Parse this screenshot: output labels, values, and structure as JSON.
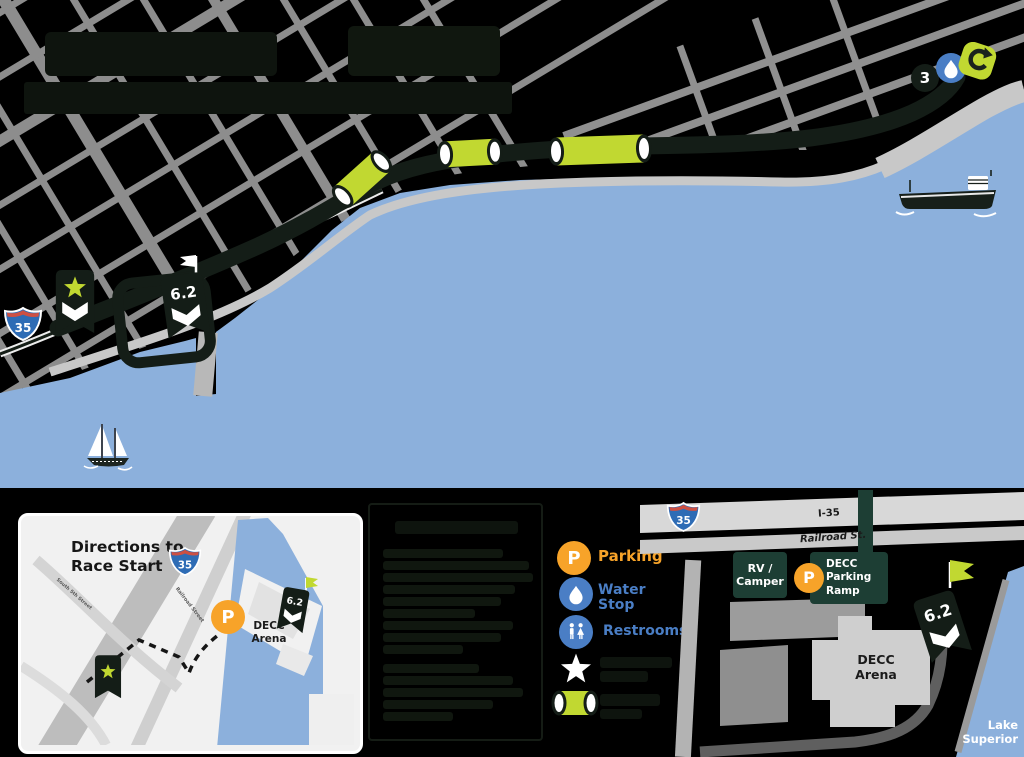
{
  "colors": {
    "water": "#8cb0dc",
    "course_dark": "#141d17",
    "lime_accent": "#c1d831",
    "legend_blue": "#4a7ec5",
    "parking_orange": "#f7a329",
    "panel_dark_green": "#1d3e34",
    "road_gray": "#8e8e8e",
    "interstate_blue": "#2e6cb5",
    "interstate_red": "#cd5043"
  },
  "main_map": {
    "interstate_shield": "35",
    "mile_marker_3": "3",
    "finish_marker": "6.2"
  },
  "inset_directions": {
    "title_line1": "Directions to",
    "title_line2": "Race Start",
    "interstate_shield": "35",
    "street_south5th": "South 5th Street",
    "street_railroad": "Railroad Street",
    "parking_symbol": "P",
    "arena_line1": "DECC",
    "arena_line2": "Arena",
    "finish_marker": "6.2"
  },
  "legend": {
    "parking_symbol": "P",
    "parking_label": "Parking",
    "water_stop_line1": "Water",
    "water_stop_line2": "Stop",
    "restrooms_label": "Restrooms"
  },
  "decc_map": {
    "interstate_shield": "35",
    "i35_road_label": "I-35",
    "railroad_st_label": "Railroad St.",
    "rv_camper_line1": "RV /",
    "rv_camper_line2": "Camper",
    "parking_symbol": "P",
    "parking_ramp_line1": "DECC",
    "parking_ramp_line2": "Parking",
    "parking_ramp_line3": "Ramp",
    "arena_line1": "DECC",
    "arena_line2": "Arena",
    "finish_marker": "6.2",
    "lake_label_line1": "Lake",
    "lake_label_line2": "Superior"
  }
}
